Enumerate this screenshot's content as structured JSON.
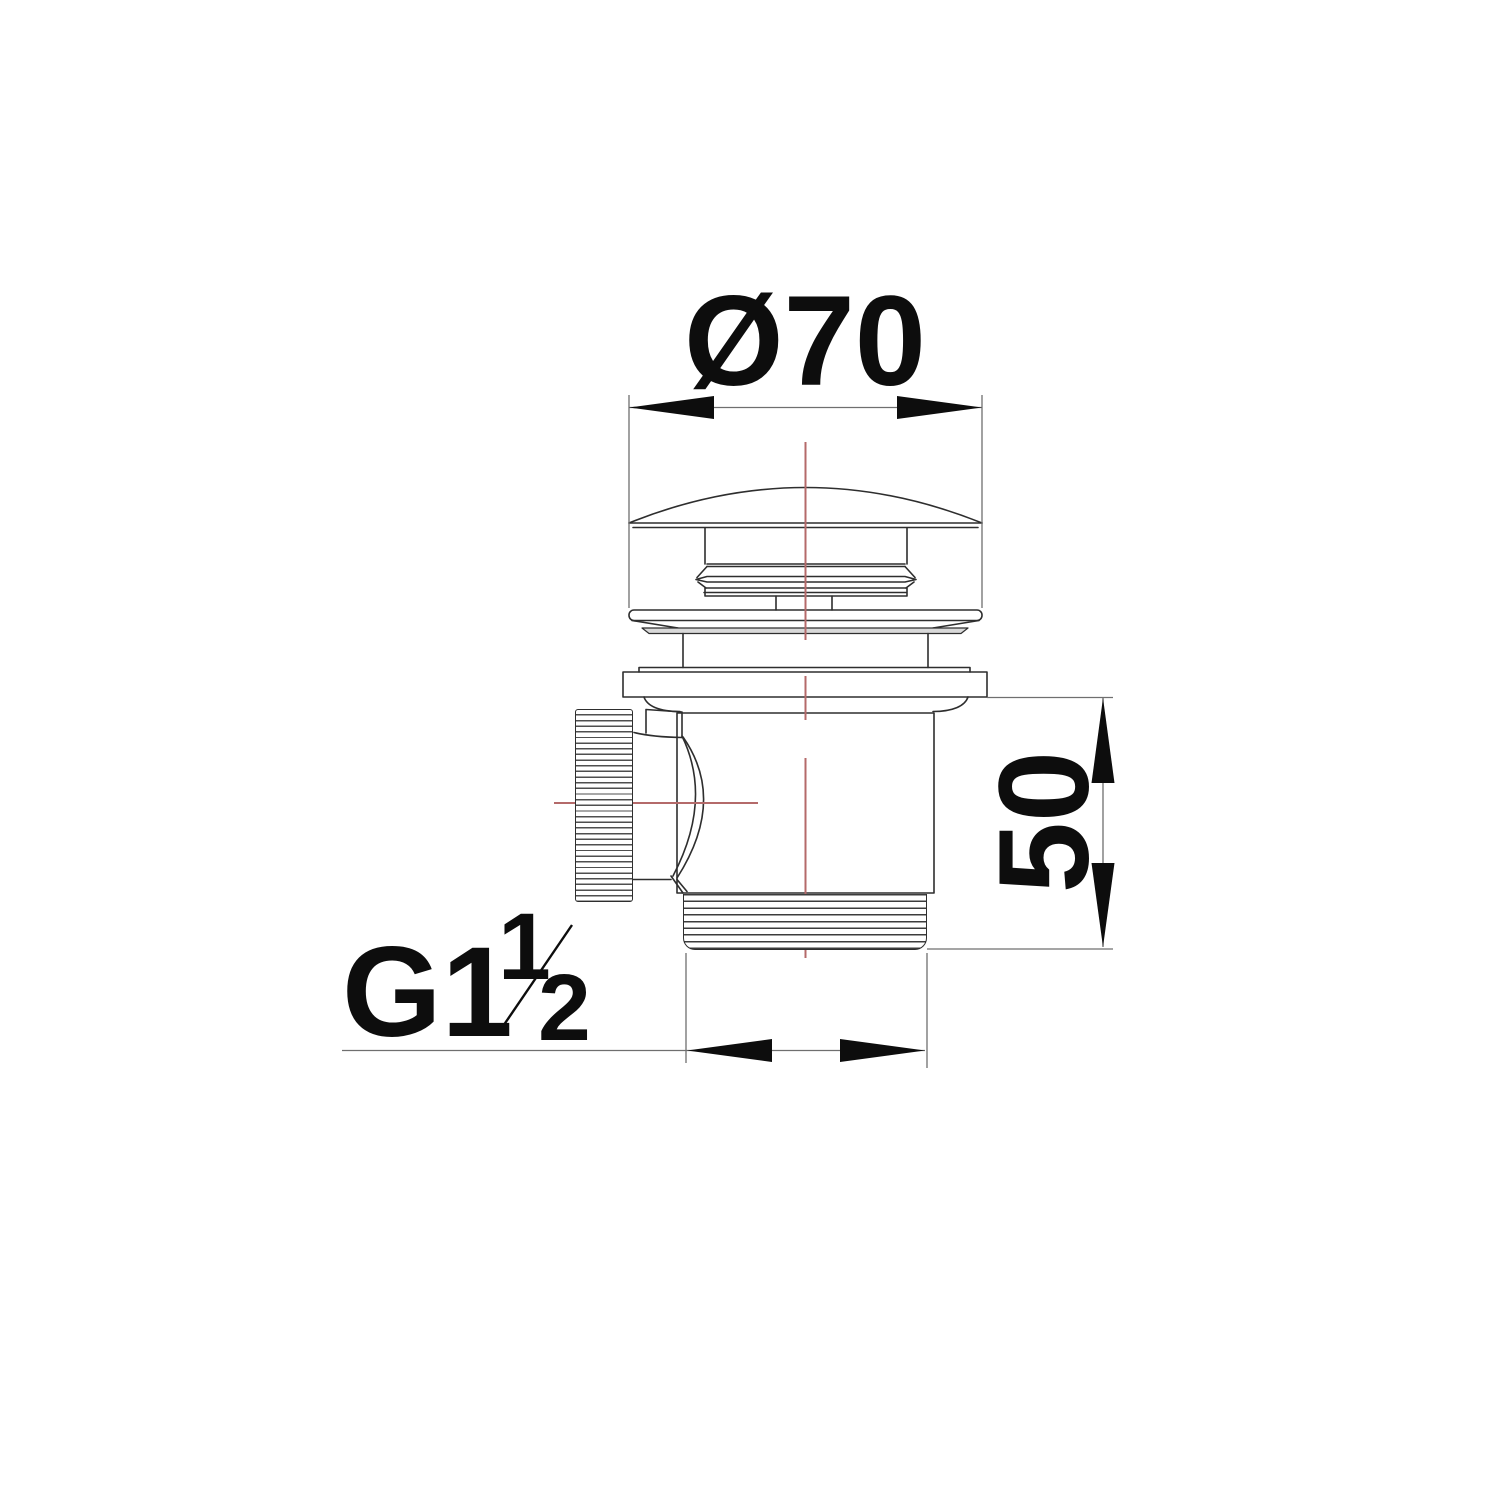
{
  "colors": {
    "line": "#2e2e2e",
    "dim_line": "#6f6f6f",
    "arrow": "#0d0d0d",
    "text": "#0d0d0d",
    "centerline": "#b46a6a",
    "band_fill": "#d9d9d9",
    "background": "#ffffff"
  },
  "labels": {
    "diameter": "Ø70",
    "height": "50",
    "thread_prefix": "G1",
    "thread_numerator": "1",
    "thread_denominator": "2"
  }
}
